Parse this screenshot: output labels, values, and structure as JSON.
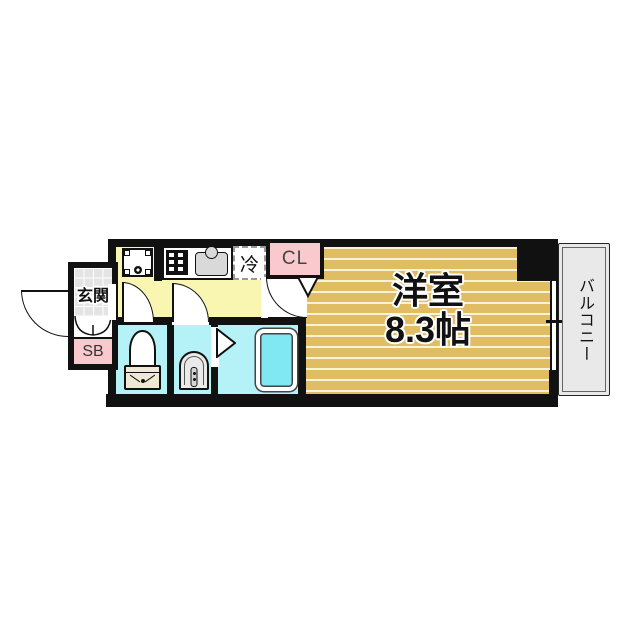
{
  "floorplan": {
    "entrance": {
      "label": "玄関"
    },
    "shoe_box": {
      "label": "SB"
    },
    "closet": {
      "label": "CL"
    },
    "refrigerator": {
      "label": "冷"
    },
    "main_room": {
      "name": "洋室",
      "size": "8.3帖"
    },
    "balcony": {
      "label": "バルコニー"
    },
    "colors": {
      "wall": "#111111",
      "kitchen_floor": "#F8F6B0",
      "wet_room_floor": "#B4F2F7",
      "bathtub": "#7FE8F2",
      "accent_pink": "#F9C9CE",
      "entrance_tile": "#E4E4E4",
      "balcony_floor": "#E9E9E9",
      "room_floor": "#E0BD62",
      "room_floor_stripe": "#FAF3DA"
    }
  }
}
